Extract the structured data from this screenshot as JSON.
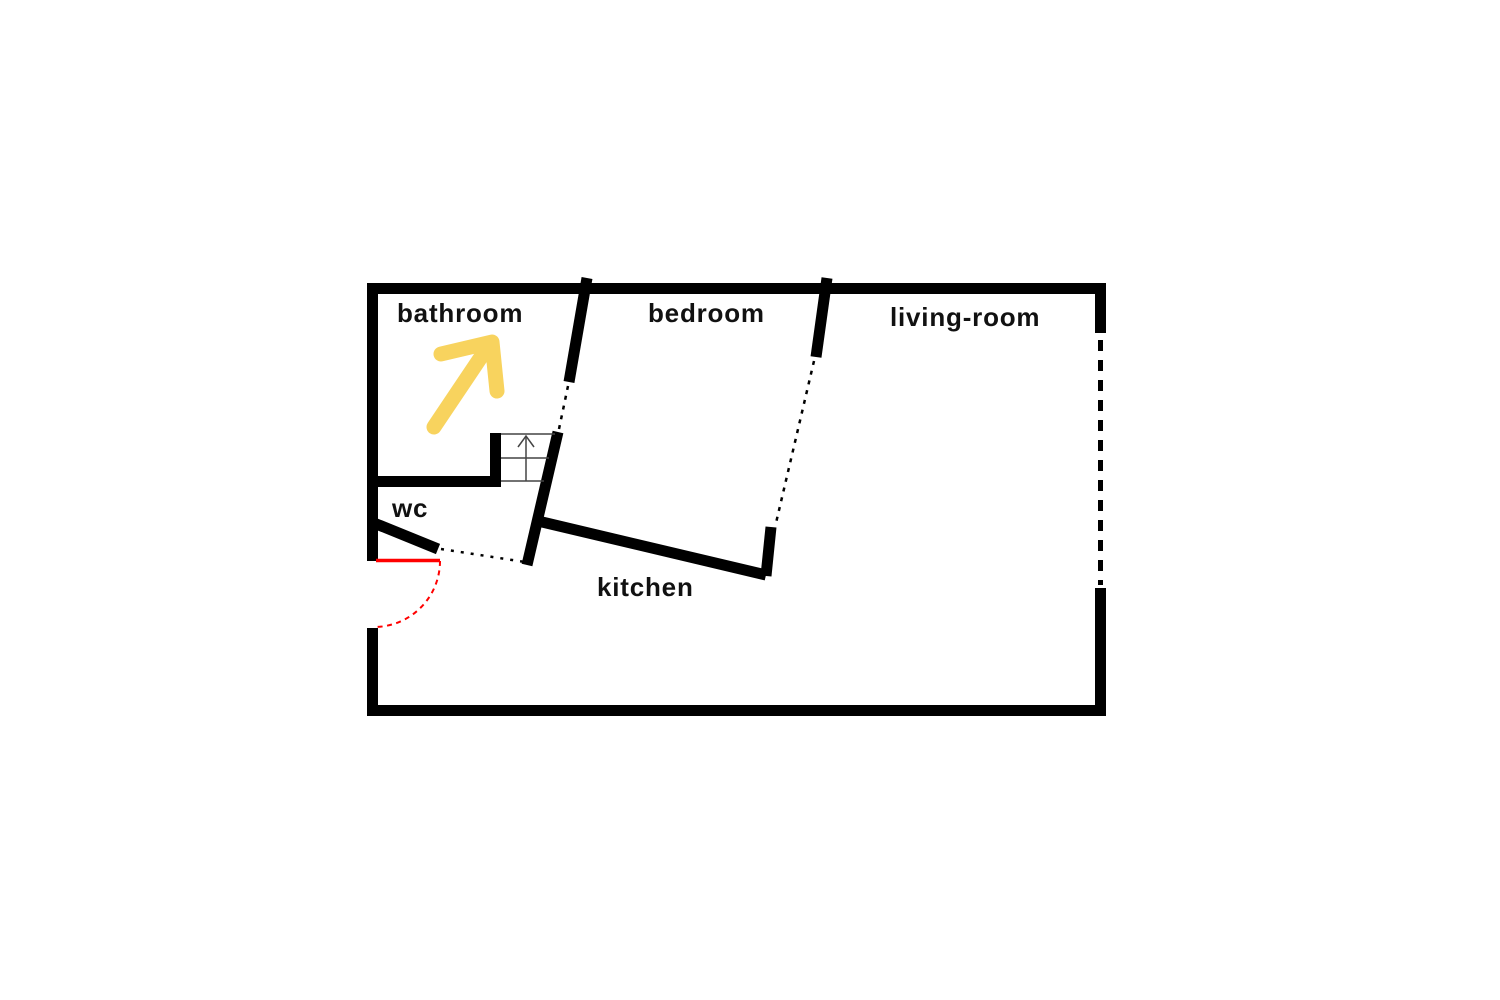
{
  "rooms": {
    "bathroom": "bathroom",
    "bedroom": "bedroom",
    "living_room": "living-room",
    "wc": "wc",
    "kitchen": "kitchen"
  },
  "colors": {
    "background": "#ffffff",
    "wall": "#000000",
    "label": "#111111",
    "arrow": "#f8d35e",
    "door": "#ff0000",
    "stairs": "#444444"
  },
  "icons": {
    "direction_arrow": "up-right-arrow-icon",
    "stairs": "stairs-up-arrow-icon",
    "entrance": "door-swing-arc-icon"
  }
}
